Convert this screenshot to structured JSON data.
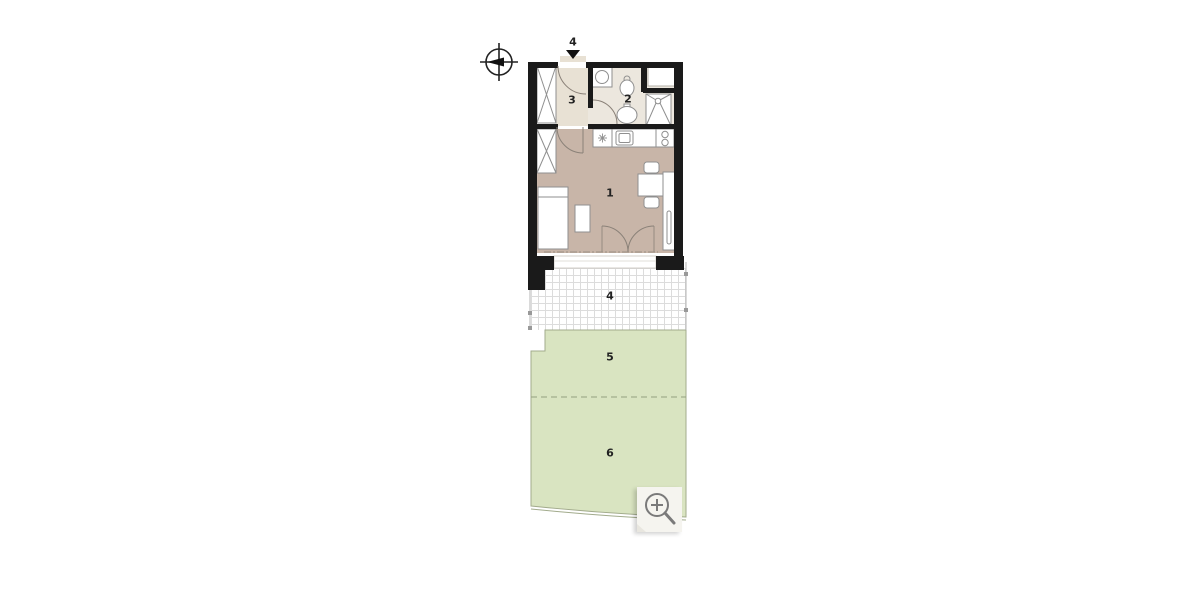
{
  "floorplan": {
    "compass": {
      "icon": "north-compass"
    },
    "entrance": {
      "label": "4",
      "icon": "down-arrow"
    },
    "rooms": [
      {
        "id": "living-room",
        "label": "1"
      },
      {
        "id": "bathroom",
        "label": "2"
      },
      {
        "id": "hallway",
        "label": "3"
      },
      {
        "id": "terrace",
        "label": "4"
      },
      {
        "id": "garden-zone-5",
        "label": "5"
      },
      {
        "id": "garden-zone-6",
        "label": "6"
      }
    ],
    "colors": {
      "wall": "#1a1a1a",
      "living_floor": "#c8b5a8",
      "hall_floor": "#e8e1d4",
      "bath_floor": "#ece7de",
      "garden": "#d9e4c1",
      "garden_border": "#a2ab8c",
      "terrace_grid": "#dcdcdc",
      "furniture_stroke": "#8f8f8f",
      "door_arc": "#8a8178",
      "label_text": "#222222"
    }
  },
  "controls": {
    "zoom_button": {
      "icon": "magnifying-glass-plus"
    }
  }
}
